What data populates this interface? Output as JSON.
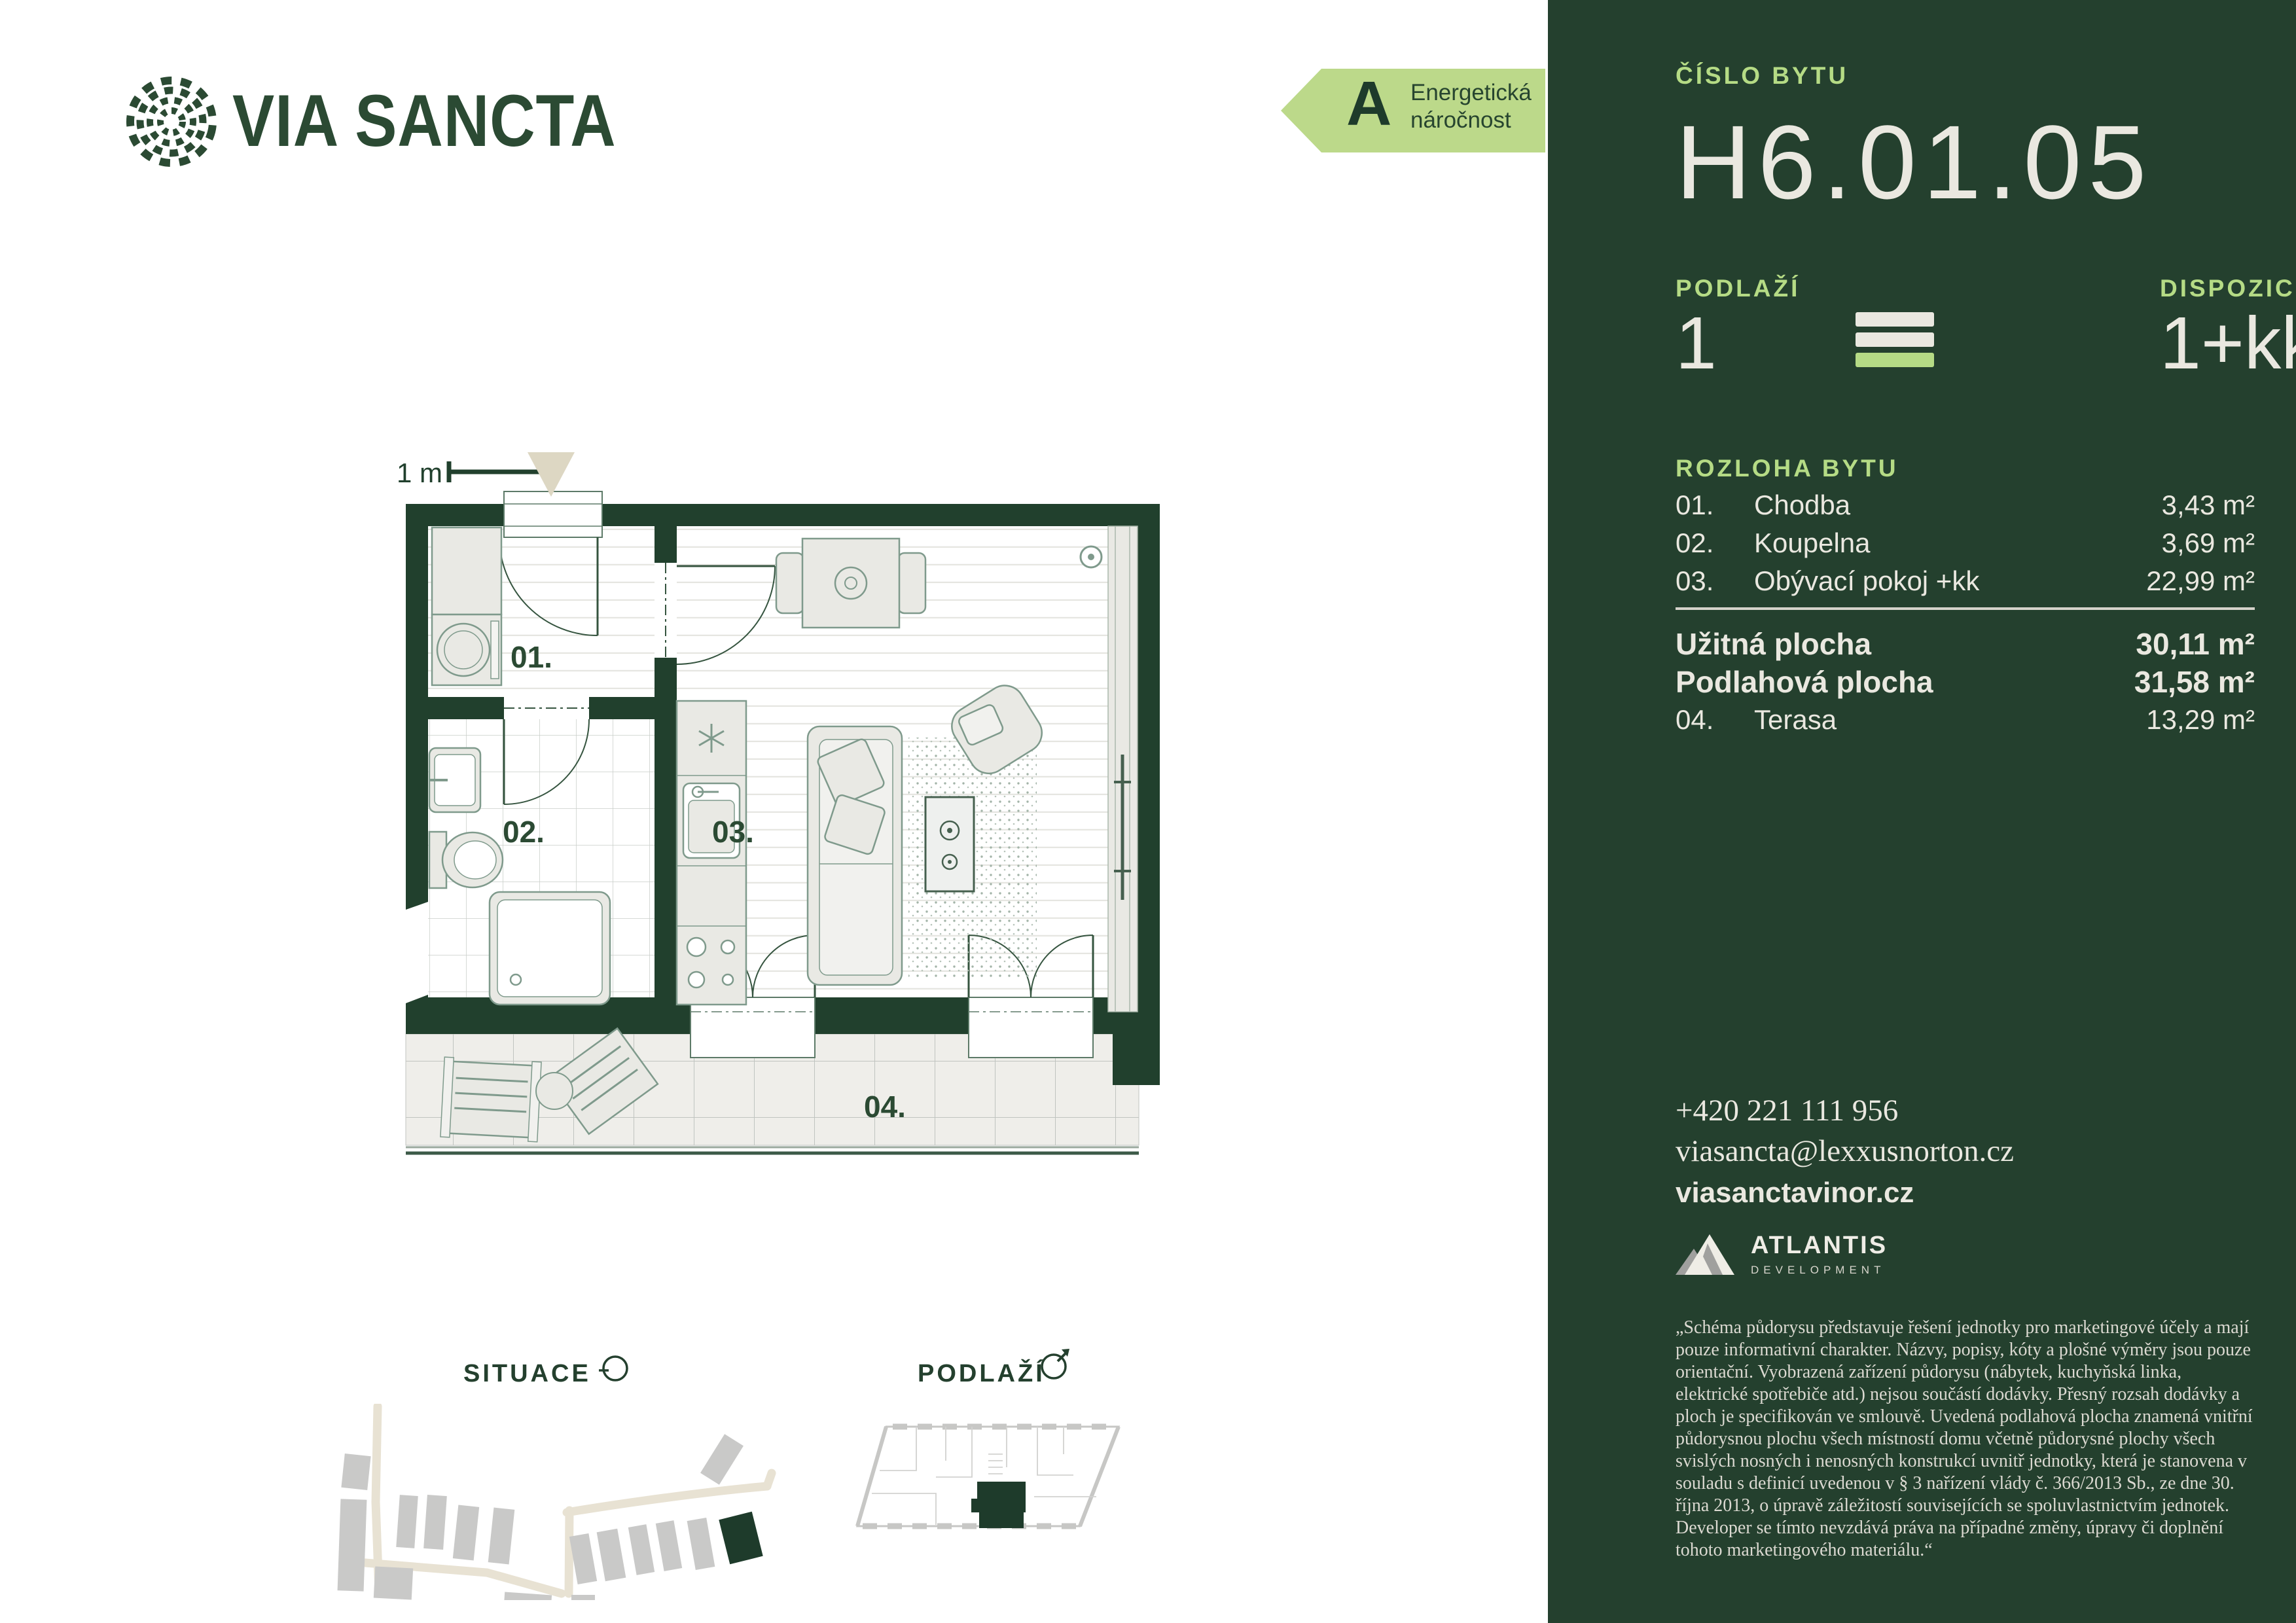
{
  "brand": {
    "wordmark": "VIA SANCTA"
  },
  "energy": {
    "grade": "A",
    "label_line1": "Energetická",
    "label_line2": "náročnost"
  },
  "plan": {
    "scale_label": "1 m",
    "labels": {
      "r01": "01.",
      "r02": "02.",
      "r03": "03.",
      "r04": "04."
    }
  },
  "diagrams": {
    "situace_label": "SITUACE",
    "podlazi_label": "PODLAŽÍ"
  },
  "sidebar": {
    "cislo_bytu_label": "ČÍSLO BYTU",
    "unit_number": "H6.01.05",
    "podlazi_label": "PODLAŽÍ",
    "podlazi_value": "1",
    "dispozice_label": "DISPOZICE",
    "dispozice_value": "1+kk",
    "rozloha_label": "ROZLOHA BYTU",
    "rooms": [
      {
        "num": "01.",
        "name": "Chodba",
        "area": "3,43 m²"
      },
      {
        "num": "02.",
        "name": "Koupelna",
        "area": "3,69 m²"
      },
      {
        "num": "03.",
        "name": "Obývací pokoj +kk",
        "area": "22,99 m²"
      }
    ],
    "summary": {
      "uzitna_name": "Užitná plocha",
      "uzitna_area": "30,11 m²",
      "podlahova_name": "Podlahová plocha",
      "podlahova_area": "31,58 m²",
      "terasa_num": "04.",
      "terasa_name": "Terasa",
      "terasa_area": "13,29 m²"
    },
    "contact": {
      "phone": "+420 221 111 956",
      "email": "viasancta@lexxusnorton.cz",
      "web": "viasanctavinor.cz"
    },
    "developer": {
      "name": "ATLANTIS",
      "division": "DEVELOPMENT"
    },
    "disclaimer": "„Schéma půdorysu představuje řešení jednotky pro marketingové účely a mají pouze informativní charakter. Názvy, popisy, kóty a plošné výměry jsou pouze orientační. Vyobrazená zařízení půdorysu (nábytek, kuchyňská linka, elektrické spotřebiče atd.) nejsou součástí dodávky. Přesný rozsah dodávky a ploch je specifikován ve smlouvě. Uvedená podlahová plocha znamená vnitřní půdorysnou plochu všech místností domu včetně půdorysné plochy všech svislých nosných i nenosných konstrukcí uvnitř jednotky, která je stanovena v souladu s definicí uvedenou v § 3 nařízení vlády č. 366/2013 Sb., ze dne 30. října 2013, o úpravě záležitostí souvisejících se spoluvlastnictvím jednotek. Developer se tímto nevzdává práva na případné změny, úpravy či doplnění tohoto marketingového materiálu.“"
  },
  "colors": {
    "sidebar_green": "#24402e",
    "wall_green": "#21402d",
    "light_green": "#b5db85",
    "off_white": "#eae8e0",
    "badge_green": "#bcd98a",
    "beige": "#ddd7c3"
  }
}
